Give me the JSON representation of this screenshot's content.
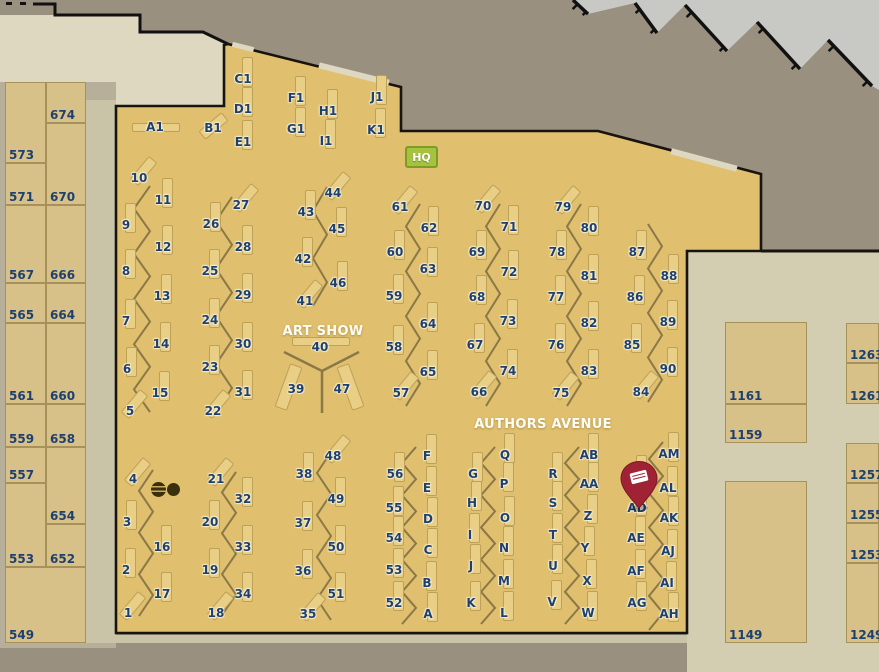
{
  "map": {
    "labels": {
      "art_show": "ART SHOW",
      "authors_avenue": "AUTHORS AVENUE",
      "hq": "HQ"
    },
    "colors": {
      "bg": "#9a9080",
      "silver": "#c8c8c5",
      "cream": "#ded8c1",
      "beige": "#d3cdb2",
      "surround": "#b7af9a",
      "corridor": "#c9c3a8",
      "hall": "#e0bf6e",
      "hall_border": "#17130e",
      "block_fill": "#d8c189",
      "block_border": "#a6915a",
      "table_fill": "#e9cf86",
      "table_border": "#bda156",
      "line": "#8a7947",
      "label_text": "#1e406f",
      "hq_bg": "#a5c33e",
      "hq_border": "#7e9b28",
      "pin": "#a02335",
      "pin_dark": "#7c1826",
      "circle": "#3a300e",
      "circle_stripe": "#c9ab5e"
    },
    "left_blocks": [
      {
        "label": "573",
        "x": 5,
        "y": 82,
        "w": 41,
        "h": 81
      },
      {
        "label": "571",
        "x": 5,
        "y": 163,
        "w": 41,
        "h": 42
      },
      {
        "label": "567",
        "x": 5,
        "y": 205,
        "w": 41,
        "h": 78
      },
      {
        "label": "565",
        "x": 5,
        "y": 283,
        "w": 41,
        "h": 40
      },
      {
        "label": "561",
        "x": 5,
        "y": 323,
        "w": 41,
        "h": 81
      },
      {
        "label": "559",
        "x": 5,
        "y": 404,
        "w": 41,
        "h": 43
      },
      {
        "label": "557",
        "x": 5,
        "y": 447,
        "w": 41,
        "h": 36
      },
      {
        "label": "553",
        "x": 5,
        "y": 483,
        "w": 41,
        "h": 84
      },
      {
        "label": "674",
        "x": 46,
        "y": 82,
        "w": 40,
        "h": 41
      },
      {
        "label": "670",
        "x": 46,
        "y": 123,
        "w": 40,
        "h": 82
      },
      {
        "label": "666",
        "x": 46,
        "y": 205,
        "w": 40,
        "h": 78
      },
      {
        "label": "664",
        "x": 46,
        "y": 283,
        "w": 40,
        "h": 40
      },
      {
        "label": "660",
        "x": 46,
        "y": 323,
        "w": 40,
        "h": 81
      },
      {
        "label": "658",
        "x": 46,
        "y": 404,
        "w": 40,
        "h": 43
      },
      {
        "label": "654",
        "x": 46,
        "y": 447,
        "w": 40,
        "h": 77
      },
      {
        "label": "652",
        "x": 46,
        "y": 524,
        "w": 40,
        "h": 43
      },
      {
        "label": "549",
        "x": 5,
        "y": 567,
        "w": 81,
        "h": 76
      }
    ],
    "right_blocks": [
      {
        "label": "1161",
        "x": 725,
        "y": 322,
        "w": 82,
        "h": 82
      },
      {
        "label": "1159",
        "x": 725,
        "y": 404,
        "w": 82,
        "h": 39
      },
      {
        "label": "1149",
        "x": 725,
        "y": 481,
        "w": 82,
        "h": 162
      },
      {
        "label": "1263",
        "x": 846,
        "y": 323,
        "w": 33,
        "h": 40
      },
      {
        "label": "1261",
        "x": 846,
        "y": 363,
        "w": 33,
        "h": 41
      },
      {
        "label": "1257",
        "x": 846,
        "y": 443,
        "w": 33,
        "h": 40
      },
      {
        "label": "1255",
        "x": 846,
        "y": 483,
        "w": 33,
        "h": 40
      },
      {
        "label": "1253",
        "x": 846,
        "y": 523,
        "w": 33,
        "h": 40
      },
      {
        "label": "1249",
        "x": 846,
        "y": 563,
        "w": 33,
        "h": 80
      }
    ],
    "booths": [
      [
        "A1",
        155,
        127,
        0,
        48,
        9,
        1,
        0
      ],
      [
        "B1",
        213,
        128,
        50,
        11,
        30,
        0,
        -2
      ],
      [
        "C1",
        243,
        79
      ],
      [
        "D1",
        243,
        109
      ],
      [
        "E1",
        243,
        142
      ],
      [
        "F1",
        296,
        98
      ],
      [
        "G1",
        296,
        129
      ],
      [
        "H1",
        328,
        111
      ],
      [
        "I1",
        326,
        141
      ],
      [
        "J1",
        377,
        97
      ],
      [
        "K1",
        376,
        130
      ],
      [
        "10",
        139,
        178,
        40
      ],
      [
        "11",
        163,
        200
      ],
      [
        "9",
        126,
        225
      ],
      [
        "12",
        163,
        247
      ],
      [
        "8",
        126,
        271
      ],
      [
        "13",
        162,
        296
      ],
      [
        "7",
        126,
        321
      ],
      [
        "14",
        161,
        344
      ],
      [
        "6",
        127,
        369
      ],
      [
        "15",
        160,
        393
      ],
      [
        "5",
        130,
        411,
        40
      ],
      [
        "27",
        241,
        205,
        40
      ],
      [
        "26",
        211,
        224
      ],
      [
        "28",
        243,
        247
      ],
      [
        "25",
        210,
        271
      ],
      [
        "29",
        243,
        295
      ],
      [
        "24",
        210,
        320
      ],
      [
        "30",
        243,
        344
      ],
      [
        "23",
        210,
        367
      ],
      [
        "31",
        243,
        392
      ],
      [
        "22",
        213,
        411,
        40
      ],
      [
        "44",
        333,
        193,
        40
      ],
      [
        "43",
        306,
        212
      ],
      [
        "45",
        337,
        229
      ],
      [
        "42",
        303,
        259
      ],
      [
        "46",
        338,
        283
      ],
      [
        "41",
        305,
        301,
        40
      ],
      [
        "40",
        320,
        347,
        0,
        58,
        9,
        1,
        -6
      ],
      [
        "39",
        296,
        389,
        20,
        13,
        46,
        -8,
        -2
      ],
      [
        "47",
        342,
        389,
        -20,
        13,
        46,
        8,
        -2
      ],
      [
        "61",
        400,
        207,
        40
      ],
      [
        "62",
        429,
        228
      ],
      [
        "60",
        395,
        252
      ],
      [
        "63",
        428,
        269
      ],
      [
        "59",
        394,
        296
      ],
      [
        "64",
        428,
        324
      ],
      [
        "58",
        394,
        347
      ],
      [
        "65",
        428,
        372
      ],
      [
        "57",
        401,
        393,
        40
      ],
      [
        "70",
        483,
        206,
        40
      ],
      [
        "71",
        509,
        227
      ],
      [
        "69",
        477,
        252
      ],
      [
        "72",
        509,
        272
      ],
      [
        "68",
        477,
        297
      ],
      [
        "73",
        508,
        321
      ],
      [
        "67",
        475,
        345
      ],
      [
        "74",
        508,
        371
      ],
      [
        "66",
        479,
        392,
        40
      ],
      [
        "79",
        563,
        207,
        40
      ],
      [
        "80",
        589,
        228
      ],
      [
        "78",
        557,
        252
      ],
      [
        "81",
        589,
        276
      ],
      [
        "77",
        556,
        297
      ],
      [
        "82",
        589,
        323
      ],
      [
        "76",
        556,
        345
      ],
      [
        "83",
        589,
        371
      ],
      [
        "75",
        561,
        393,
        40
      ],
      [
        "87",
        637,
        252
      ],
      [
        "88",
        669,
        276
      ],
      [
        "86",
        635,
        297
      ],
      [
        "89",
        668,
        322
      ],
      [
        "85",
        632,
        345
      ],
      [
        "90",
        668,
        369
      ],
      [
        "84",
        641,
        392,
        40
      ],
      [
        "4",
        133,
        479,
        40
      ],
      [
        "3",
        127,
        522
      ],
      [
        "16",
        162,
        547
      ],
      [
        "2",
        126,
        570
      ],
      [
        "17",
        162,
        594
      ],
      [
        "1",
        128,
        613,
        40
      ],
      [
        "21",
        216,
        479,
        40
      ],
      [
        "32",
        243,
        499
      ],
      [
        "20",
        210,
        522
      ],
      [
        "33",
        243,
        547
      ],
      [
        "19",
        210,
        570
      ],
      [
        "34",
        243,
        594
      ],
      [
        "18",
        216,
        613,
        40
      ],
      [
        "48",
        333,
        456,
        40
      ],
      [
        "38",
        304,
        474
      ],
      [
        "49",
        336,
        499
      ],
      [
        "37",
        303,
        523
      ],
      [
        "50",
        336,
        547
      ],
      [
        "36",
        303,
        571
      ],
      [
        "51",
        336,
        594
      ],
      [
        "35",
        308,
        614,
        40
      ],
      [
        "56",
        395,
        474
      ],
      [
        "55",
        394,
        508
      ],
      [
        "54",
        394,
        538
      ],
      [
        "53",
        394,
        570
      ],
      [
        "52",
        394,
        603
      ],
      [
        "F",
        427,
        456
      ],
      [
        "E",
        427,
        488
      ],
      [
        "D",
        428,
        519
      ],
      [
        "C",
        428,
        550
      ],
      [
        "B",
        427,
        583
      ],
      [
        "A",
        428,
        614
      ],
      [
        "G",
        473,
        474
      ],
      [
        "H",
        472,
        503
      ],
      [
        "I",
        470,
        535
      ],
      [
        "J",
        471,
        566
      ],
      [
        "K",
        471,
        603
      ],
      [
        "Q",
        505,
        455
      ],
      [
        "P",
        504,
        484
      ],
      [
        "O",
        505,
        518
      ],
      [
        "N",
        504,
        548
      ],
      [
        "M",
        504,
        581
      ],
      [
        "L",
        504,
        613
      ],
      [
        "R",
        553,
        474
      ],
      [
        "S",
        553,
        503
      ],
      [
        "T",
        553,
        535
      ],
      [
        "U",
        553,
        566
      ],
      [
        "V",
        552,
        602
      ],
      [
        "AB",
        589,
        455
      ],
      [
        "AA",
        589,
        484
      ],
      [
        "Z",
        588,
        516
      ],
      [
        "Y",
        585,
        548
      ],
      [
        "X",
        587,
        581
      ],
      [
        "W",
        588,
        613
      ],
      [
        "",
        637,
        477
      ],
      [
        "AD",
        637,
        508
      ],
      [
        "AE",
        636,
        538
      ],
      [
        "AF",
        636,
        571
      ],
      [
        "AG",
        637,
        603
      ],
      [
        "AM",
        669,
        454
      ],
      [
        "AL",
        668,
        488
      ],
      [
        "AK",
        669,
        518
      ],
      [
        "AJ",
        668,
        551
      ],
      [
        "AI",
        667,
        583
      ],
      [
        "AH",
        669,
        614
      ]
    ],
    "geometry": {
      "hall_outline": [
        [
          116,
          106
        ],
        [
          224,
          106
        ],
        [
          224,
          45
        ],
        [
          228,
          44
        ],
        [
          401,
          87
        ],
        [
          401,
          131
        ],
        [
          598,
          131
        ],
        [
          761,
          174
        ],
        [
          761,
          251
        ],
        [
          687,
          251
        ],
        [
          687,
          633
        ],
        [
          116,
          633
        ]
      ],
      "cream_poly": [
        [
          0,
          15
        ],
        [
          140,
          15
        ],
        [
          140,
          32
        ],
        [
          203,
          32
        ],
        [
          228,
          44
        ],
        [
          228,
          106
        ],
        [
          116,
          106
        ],
        [
          116,
          132
        ],
        [
          0,
          132
        ]
      ],
      "silver_poly": [
        [
          566,
          0
        ],
        [
          879,
          0
        ],
        [
          879,
          90
        ],
        [
          872,
          86
        ],
        [
          828,
          40
        ],
        [
          800,
          69
        ],
        [
          757,
          22
        ],
        [
          727,
          51
        ],
        [
          685,
          5
        ],
        [
          657,
          33
        ],
        [
          635,
          3
        ],
        [
          588,
          14
        ],
        [
          573,
          0
        ]
      ],
      "dock_walls": [
        [
          573,
          0,
          588,
          14
        ],
        [
          635,
          3,
          657,
          33
        ],
        [
          685,
          5,
          727,
          51
        ],
        [
          757,
          22,
          800,
          69
        ],
        [
          828,
          40,
          872,
          86
        ]
      ],
      "dock_ticks": [
        [
          576,
          4
        ],
        [
          639,
          8
        ],
        [
          690,
          12
        ],
        [
          762,
          28
        ],
        [
          832,
          46
        ],
        [
          586,
          10
        ],
        [
          654,
          28
        ],
        [
          723,
          46
        ],
        [
          795,
          64
        ],
        [
          866,
          81
        ]
      ],
      "step_path": "M33,4 H55 V15 H140 V32 H203 L228,44",
      "top_dashes": [
        [
          6,
          2
        ],
        [
          20,
          2
        ]
      ],
      "door_stripes": [
        [
          243,
          47,
          22,
          5,
          14
        ],
        [
          354,
          74,
          72,
          6,
          14
        ],
        [
          704,
          160,
          68,
          6,
          15
        ]
      ],
      "outside_line": [
        761,
        251,
        879,
        251
      ],
      "zigzags": [
        {
          "x1": 150,
          "x2": 134,
          "y1": 186,
          "y2": 412,
          "n": 10
        },
        {
          "x1": 232,
          "x2": 216,
          "y1": 197,
          "y2": 412,
          "n": 9
        },
        {
          "x1": 327,
          "x2": 313,
          "y1": 187,
          "y2": 306,
          "n": 5
        },
        {
          "x1": 420,
          "x2": 406,
          "y1": 204,
          "y2": 406,
          "n": 9
        },
        {
          "x1": 500,
          "x2": 486,
          "y1": 204,
          "y2": 406,
          "n": 9
        },
        {
          "x1": 581,
          "x2": 567,
          "y1": 204,
          "y2": 406,
          "n": 9
        },
        {
          "x1": 648,
          "x2": 662,
          "y1": 224,
          "y2": 402,
          "n": 8
        },
        {
          "x1": 153,
          "x2": 139,
          "y1": 470,
          "y2": 616,
          "n": 7
        },
        {
          "x1": 236,
          "x2": 222,
          "y1": 472,
          "y2": 615,
          "n": 7
        },
        {
          "x1": 331,
          "x2": 317,
          "y1": 452,
          "y2": 620,
          "n": 8
        },
        {
          "x1": 416,
          "x2": 402,
          "y1": 447,
          "y2": 624,
          "n": 11
        },
        {
          "x1": 495,
          "x2": 481,
          "y1": 447,
          "y2": 624,
          "n": 11
        },
        {
          "x1": 579,
          "x2": 565,
          "y1": 447,
          "y2": 624,
          "n": 11
        },
        {
          "x1": 663,
          "x2": 649,
          "y1": 442,
          "y2": 630,
          "n": 11
        }
      ],
      "y_shape": "M284,352 L322,371 L359,352 M322,371 L322,413"
    },
    "markers": {
      "pin_position": {
        "x": 620,
        "y": 461
      },
      "art_show_center": {
        "x": 323,
        "y": 331
      },
      "authors_avenue_center": {
        "x": 543,
        "y": 424
      }
    }
  }
}
